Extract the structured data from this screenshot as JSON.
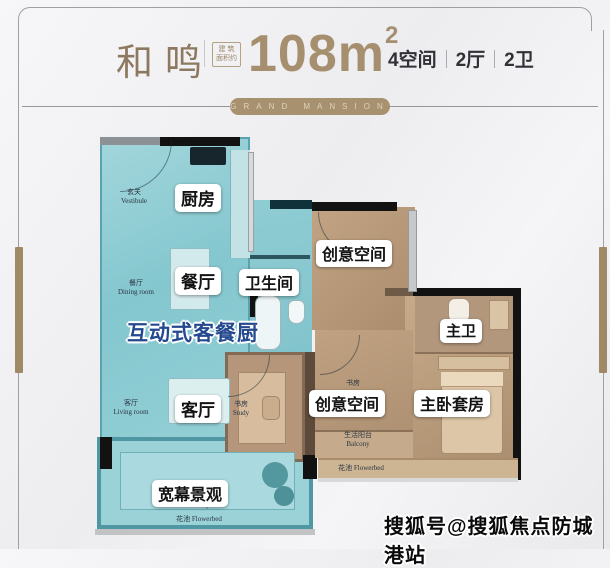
{
  "header": {
    "title": "和鸣",
    "area_badge": "建 筑\n面积约",
    "area_value": "108m",
    "area_sup": "2",
    "specs": [
      "4空间",
      "2厅",
      "2卫"
    ]
  },
  "banner": {
    "text": "GRAND MANSION"
  },
  "floorplan": {
    "rooms": {
      "kitchen": "厨房",
      "dining": "餐厅",
      "bathroom": "卫生间",
      "creative_top": "创意空间",
      "master_bath": "主卫",
      "living": "客厅",
      "creative_bottom": "创意空间",
      "master_suite": "主卧套房",
      "view": "宽幕景观"
    },
    "feature_text": "互动式客餐厨",
    "annotations": {
      "vestibule": "玄关\nVestibule",
      "dining_small": "餐厅\nDining room",
      "living_small": "客厅\nLiving room",
      "study_nook": "书房\nStudy",
      "study_room": "书房",
      "life_balcony": "生活阳台\nBalcony",
      "flowerbed_right": "花池 Flowerbed",
      "balcony_en": "Balcony",
      "flowerbed_bottom": "花池 Flowerbed"
    }
  },
  "watermark": "搜狐号@搜狐焦点防城港站",
  "colors": {
    "gold": "#a08a66",
    "teal": "#8ecdd4",
    "tan": "#b3967a",
    "feature_blue": "#24498f"
  }
}
